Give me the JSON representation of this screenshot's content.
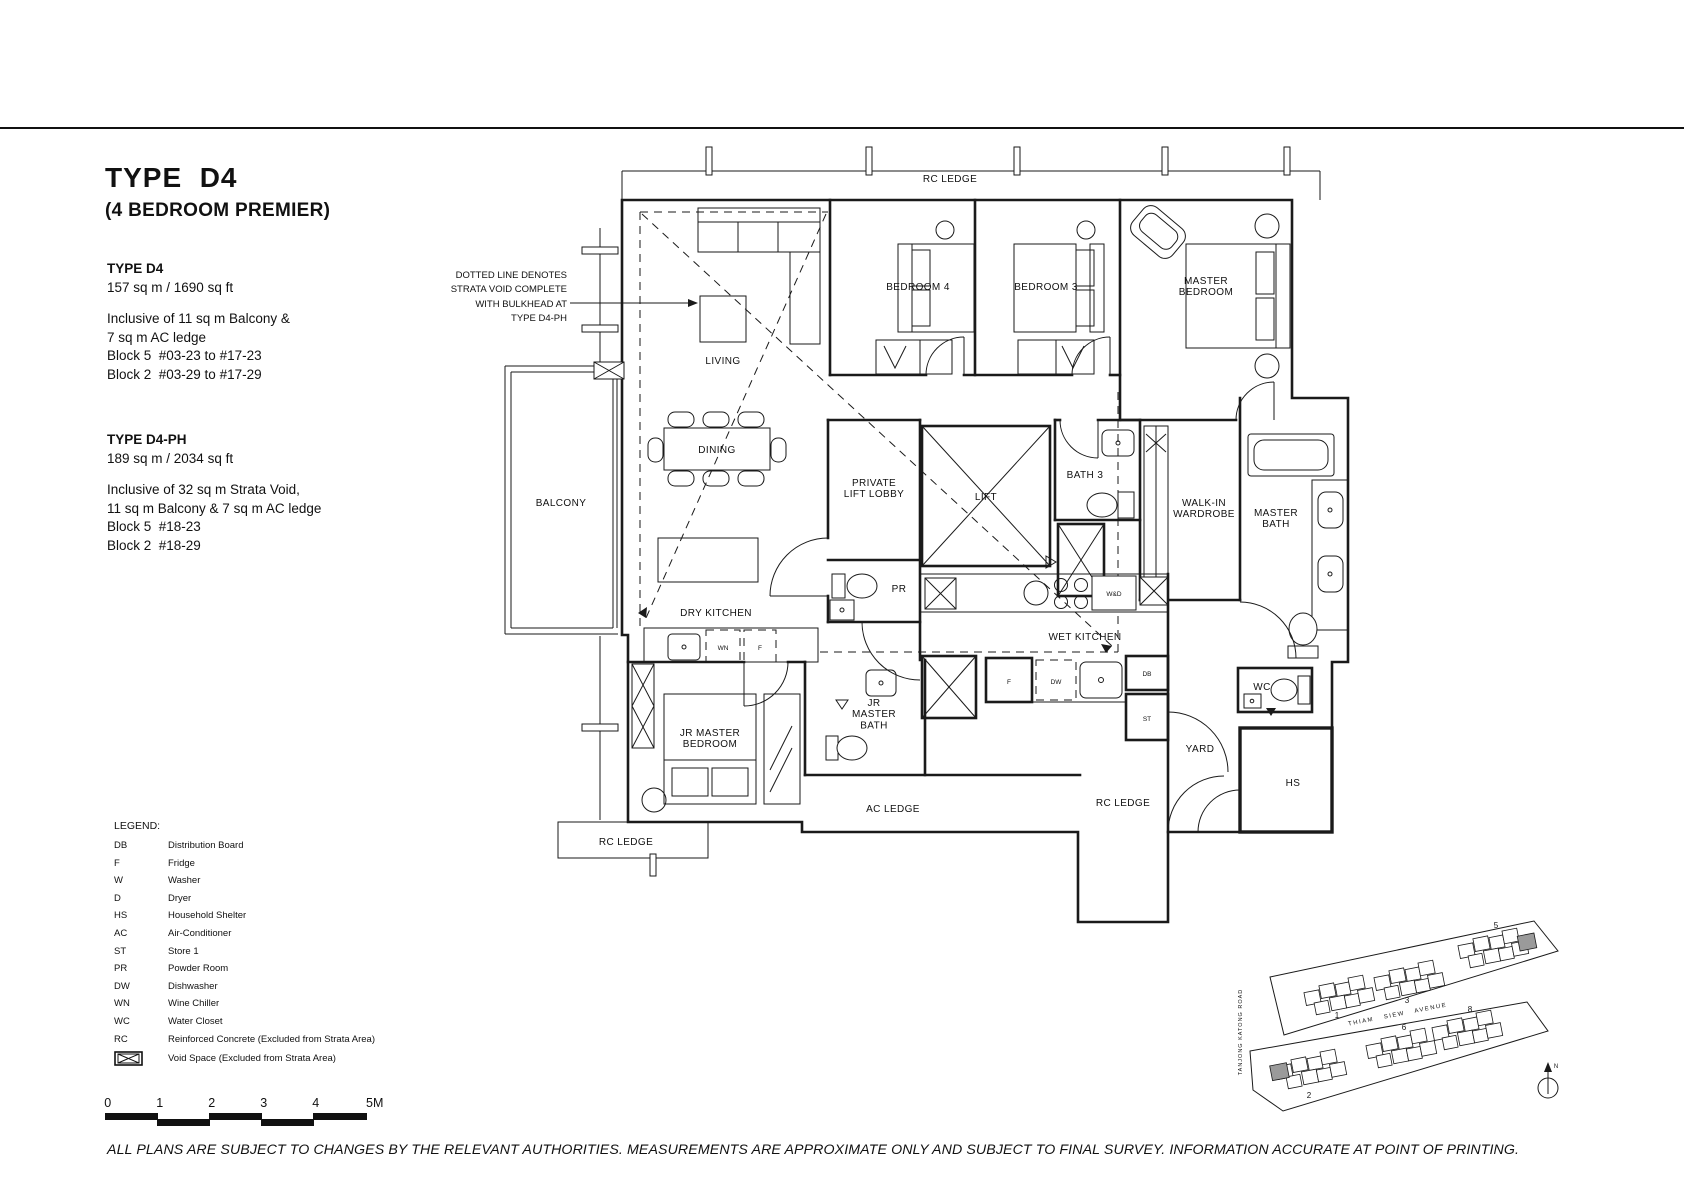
{
  "header": {
    "title": "TYPE  D4",
    "subtitle": "(4 BEDROOM PREMIER)"
  },
  "specs": [
    {
      "heading": "TYPE D4",
      "area": "157 sq m / 1690 sq ft",
      "lines": [
        "Inclusive of 11 sq m Balcony &",
        "7 sq m AC ledge",
        "Block 5  #03-23 to #17-23",
        "Block 2  #03-29 to #17-29"
      ]
    },
    {
      "heading": "TYPE D4-PH",
      "area": "189 sq m / 2034 sq ft",
      "lines": [
        "Inclusive of 32 sq m Strata Void,",
        "11 sq m Balcony & 7 sq m AC ledge",
        "Block 5  #18-23",
        "Block 2  #18-29"
      ]
    }
  ],
  "note_lines": [
    "DOTTED LINE DENOTES",
    "STRATA VOID COMPLETE",
    "WITH BULKHEAD AT",
    "TYPE D4-PH"
  ],
  "legend": {
    "title": "LEGEND:",
    "items": [
      {
        "abbr": "DB",
        "desc": "Distribution Board"
      },
      {
        "abbr": "F",
        "desc": "Fridge"
      },
      {
        "abbr": "W",
        "desc": "Washer"
      },
      {
        "abbr": "D",
        "desc": "Dryer"
      },
      {
        "abbr": "HS",
        "desc": "Household Shelter"
      },
      {
        "abbr": "AC",
        "desc": "Air-Conditioner"
      },
      {
        "abbr": "ST",
        "desc": "Store 1"
      },
      {
        "abbr": "PR",
        "desc": "Powder Room"
      },
      {
        "abbr": "DW",
        "desc": "Dishwasher"
      },
      {
        "abbr": "WN",
        "desc": "Wine Chiller"
      },
      {
        "abbr": "WC",
        "desc": "Water Closet"
      },
      {
        "abbr": "RC",
        "desc": "Reinforced Concrete (Excluded from Strata Area)"
      }
    ],
    "void_icon_desc": "Void Space (Excluded from Strata Area)"
  },
  "scalebar": {
    "labels": [
      "0",
      "1",
      "2",
      "3",
      "4",
      "5M"
    ]
  },
  "disclaimer": "ALL PLANS ARE SUBJECT TO CHANGES BY THE RELEVANT AUTHORITIES. MEASUREMENTS ARE APPROXIMATE ONLY AND SUBJECT TO FINAL SURVEY. INFORMATION ACCURATE AT POINT OF PRINTING.",
  "plan": {
    "rc_ledge_top": "RC LEDGE",
    "living": "LIVING",
    "dining": "DINING",
    "dry_kitchen": "DRY KITCHEN",
    "wet_kitchen": "WET KITCHEN",
    "balcony": "BALCONY",
    "bedroom4": "BEDROOM 4",
    "bedroom3": "BEDROOM 3",
    "master_bedroom": [
      "MASTER",
      "BEDROOM"
    ],
    "private_lift_lobby": [
      "PRIVATE",
      "LIFT LOBBY"
    ],
    "lift": "LIFT",
    "bath3": "BATH 3",
    "walk_in_wardrobe": [
      "WALK-IN",
      "WARDROBE"
    ],
    "master_bath": [
      "MASTER",
      "BATH"
    ],
    "pr": "PR",
    "wd": "W&D",
    "wn": "WN",
    "f_dry": "F",
    "f_wet": "F",
    "dw": "DW",
    "db": "DB",
    "st": "ST",
    "wc": "WC",
    "yard": "YARD",
    "hs": "HS",
    "jr_master_bedroom": [
      "JR MASTER",
      "BEDROOM"
    ],
    "jr_master_bath": [
      "JR",
      "MASTER",
      "BATH"
    ],
    "ac_ledge": "AC LEDGE",
    "rc_ledge_bottom": "RC LEDGE",
    "rc_ledge_left": "RC LEDGE"
  },
  "site": {
    "avenue": "THIAM SIEW AVENUE",
    "road": "TANJONG KATONG ROAD",
    "blocks": [
      "1",
      "3",
      "5",
      "2",
      "6",
      "8"
    ],
    "north": "N"
  },
  "colors": {
    "ink": "#1a1a1a",
    "highlight": "#9a9a9a",
    "background": "#ffffff"
  }
}
